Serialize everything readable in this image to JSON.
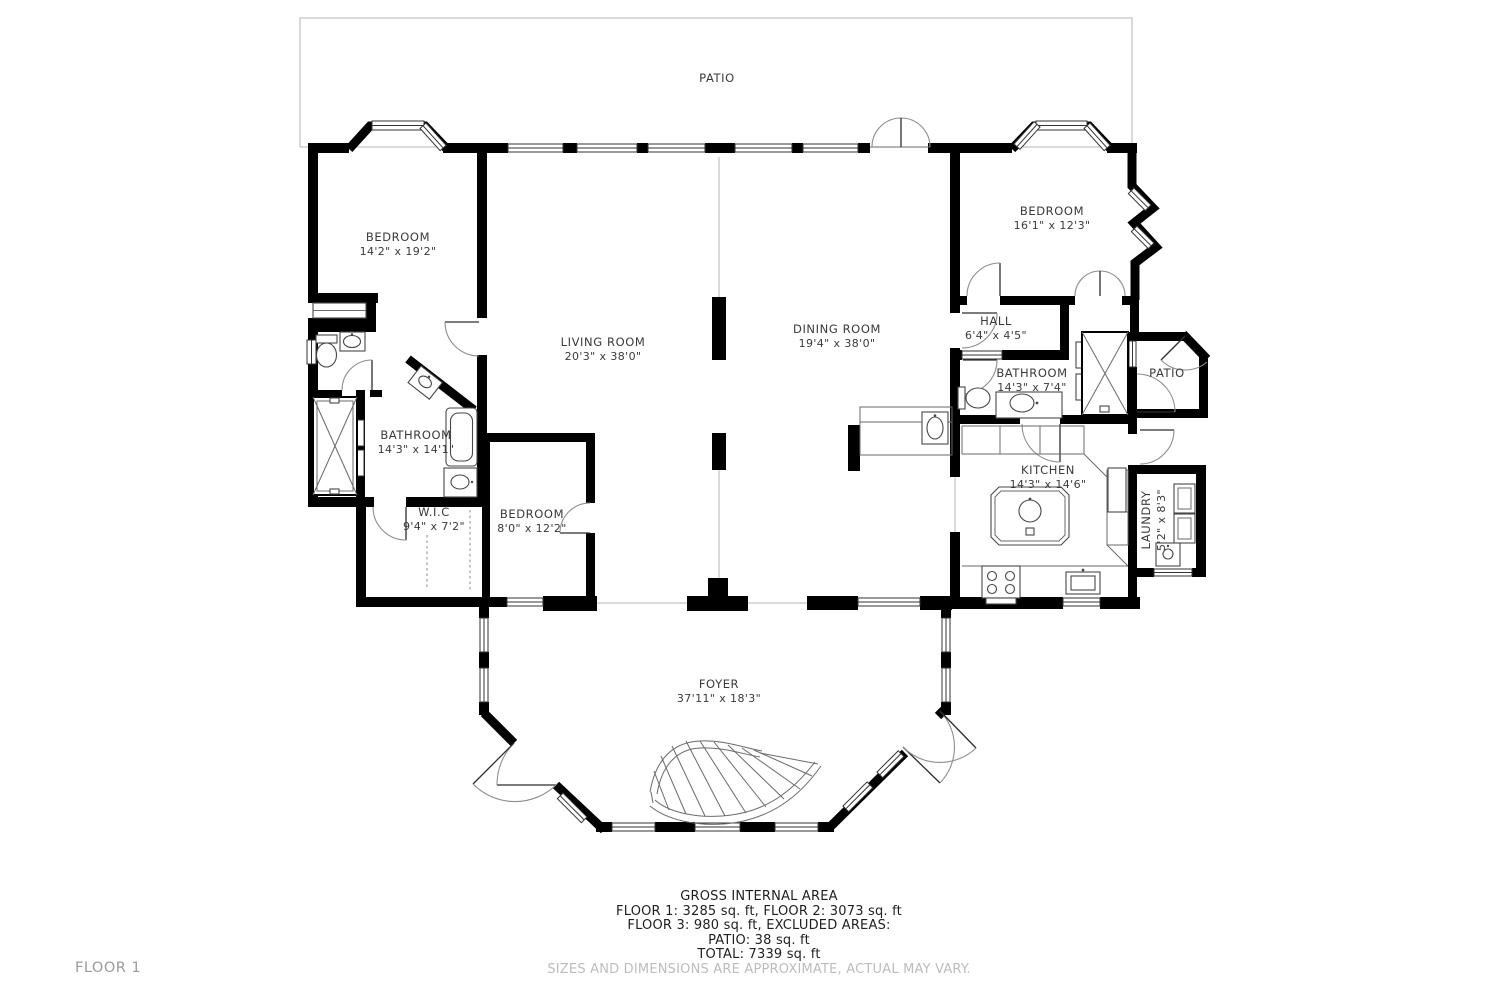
{
  "plan": {
    "floor_label": "FLOOR 1",
    "rooms": {
      "patio_top": {
        "name": "PATIO"
      },
      "bedroom_left": {
        "name": "BEDROOM",
        "dims": "14'2\" x 19'2\""
      },
      "living": {
        "name": "LIVING ROOM",
        "dims": "20'3\" x 38'0\""
      },
      "dining": {
        "name": "DINING ROOM",
        "dims": "19'4\" x 38'0\""
      },
      "bedroom_right": {
        "name": "BEDROOM",
        "dims": "16'1\" x 12'3\""
      },
      "hall": {
        "name": "HALL",
        "dims": "6'4\" x 4'5\""
      },
      "bathroom_right": {
        "name": "BATHROOM",
        "dims": "14'3\" x 7'4\""
      },
      "patio_right": {
        "name": "PATIO"
      },
      "bathroom_left": {
        "name": "BATHROOM",
        "dims": "14'3\" x 14'1\""
      },
      "wic": {
        "name": "W.I.C",
        "dims": "9'4\" x 7'2\""
      },
      "bedroom_small": {
        "name": "BEDROOM",
        "dims": "8'0\" x 12'2\""
      },
      "kitchen": {
        "name": "KITCHEN",
        "dims": "14'3\" x 14'6\""
      },
      "laundry": {
        "name": "LAUNDRY",
        "dims": "5'2\" x 8'3\""
      },
      "foyer": {
        "name": "FOYER",
        "dims": "37'11\" x 18'3\""
      }
    },
    "footer": {
      "gross_title": "GROSS INTERNAL AREA",
      "line1": "FLOOR 1: 3285 sq. ft, FLOOR 2: 3073 sq. ft",
      "line2": "FLOOR 3: 980 sq. ft, EXCLUDED AREAS:",
      "line3": "PATIO: 38 sq. ft",
      "line4": "TOTAL: 7339 sq. ft",
      "disclaimer": "SIZES AND DIMENSIONS ARE APPROXIMATE, ACTUAL MAY VARY."
    },
    "colors": {
      "wall": "#000000",
      "fixture_line": "#474747",
      "label_text": "#3a3a3a",
      "muted_text": "#9b9b9b",
      "disclaimer_text": "#bcbcbc"
    }
  }
}
